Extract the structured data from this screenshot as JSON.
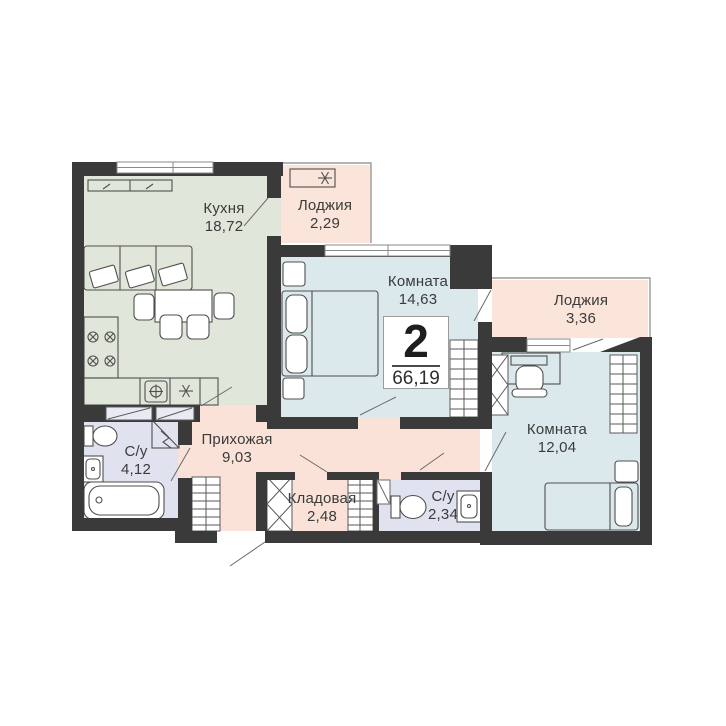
{
  "plan": {
    "badge": {
      "rooms_count": "2",
      "total_area": "66,19"
    },
    "rooms": [
      {
        "id": "kitchen",
        "name": "Кухня",
        "area": "18,72"
      },
      {
        "id": "loggia-1",
        "name": "Лоджия",
        "area": "2,29"
      },
      {
        "id": "room-1",
        "name": "Комната",
        "area": "14,63"
      },
      {
        "id": "loggia-2",
        "name": "Лоджия",
        "area": "3,36"
      },
      {
        "id": "room-2",
        "name": "Комната",
        "area": "12,04"
      },
      {
        "id": "bathroom-1",
        "name": "С/у",
        "area": "4,12"
      },
      {
        "id": "hallway",
        "name": "Прихожая",
        "area": "9,03"
      },
      {
        "id": "storage",
        "name": "Кладовая",
        "area": "2,48"
      },
      {
        "id": "bathroom-2",
        "name": "С/у",
        "area": "2,34"
      }
    ],
    "icons": {
      "vent": "6-spoke-star",
      "shower": "corner-diagonal"
    },
    "colors": {
      "wall": "#3a3a3a",
      "kitchen": "#e0e7da",
      "living_room": "#dbe9ec",
      "loggia": "#fbe4d9",
      "hallway": "#fae2d8",
      "bathroom": "#e1e2f0",
      "cabinet": "#e9eaf4",
      "outline": "#9a9a9a",
      "furniture_line": "#4f4f4f"
    }
  }
}
